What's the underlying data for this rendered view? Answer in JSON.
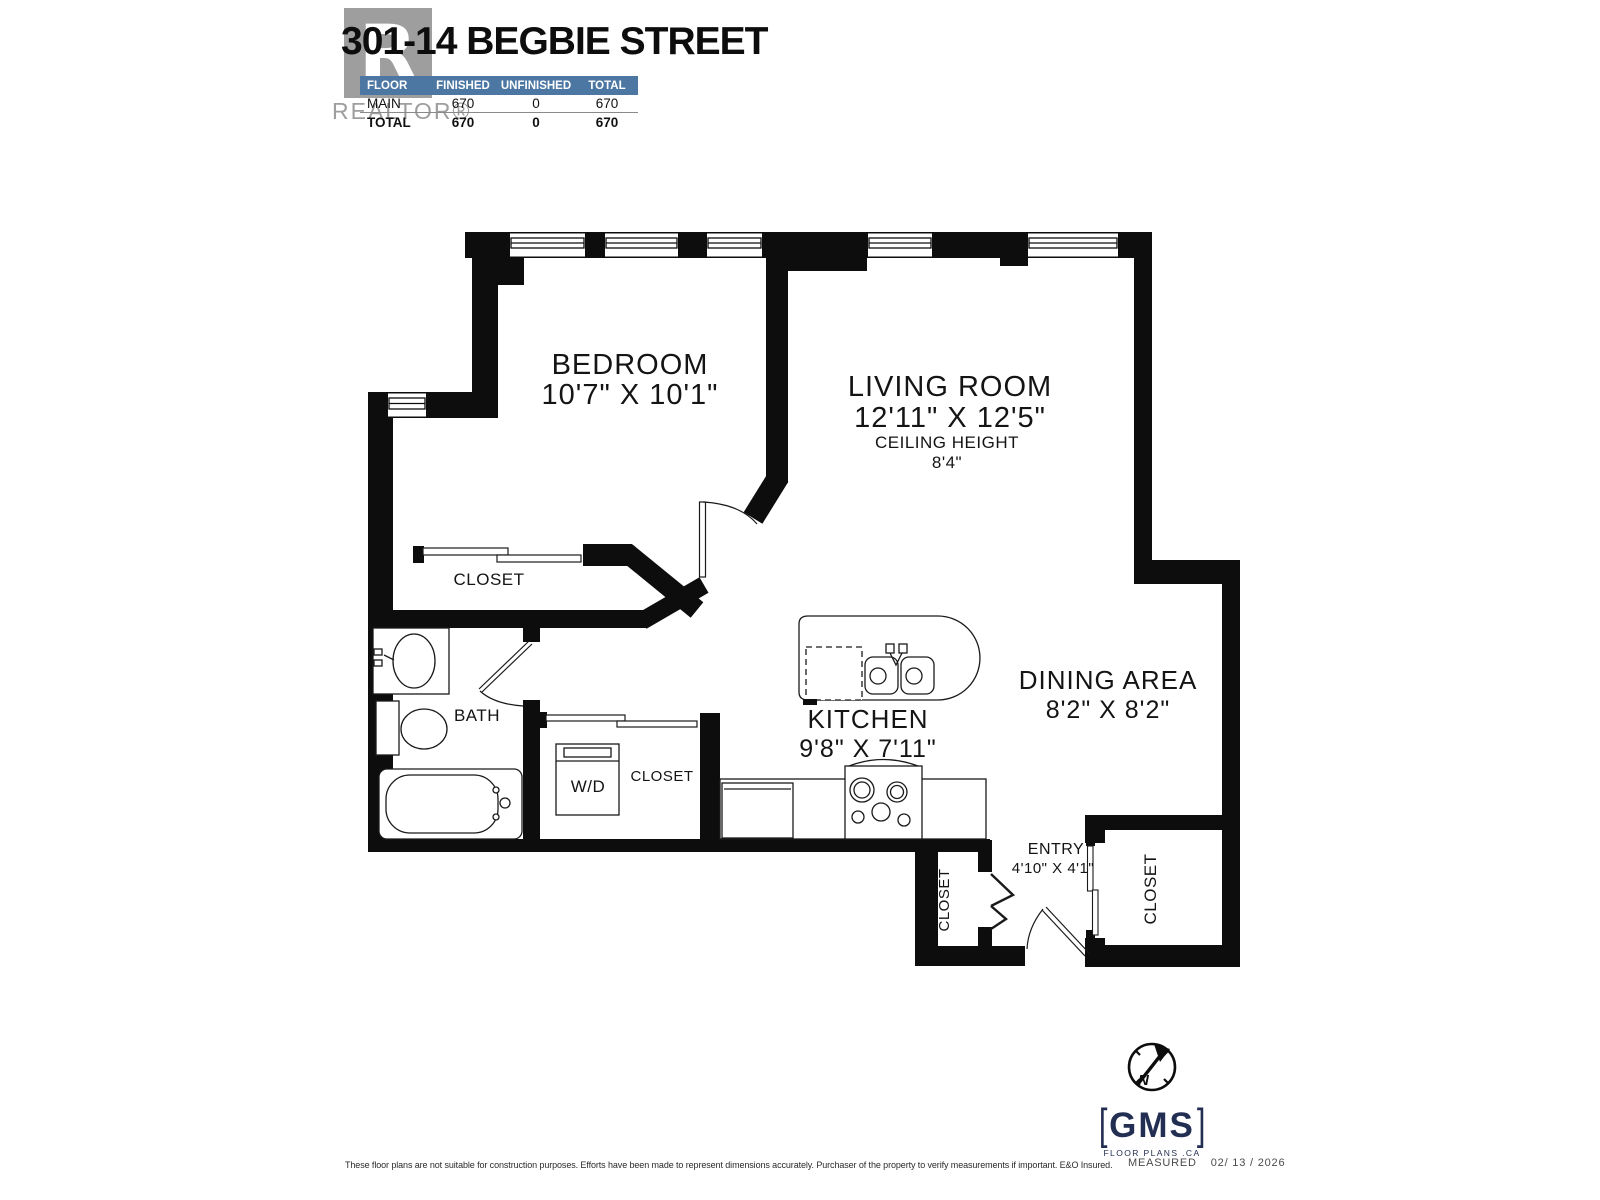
{
  "title": "301-14 BEGBIE STREET",
  "watermark": {
    "letter": "R",
    "brand": "REALTOR®"
  },
  "area_table": {
    "headers": [
      "FLOOR",
      "FINISHED",
      "UNFINISHED",
      "TOTAL"
    ],
    "header_bg": "#4c77a3",
    "rows": [
      {
        "floor": "MAIN",
        "finished": "670",
        "unfinished": "0",
        "total": "670"
      },
      {
        "floor": "TOTAL",
        "finished": "670",
        "unfinished": "0",
        "total": "670"
      }
    ]
  },
  "plan": {
    "bedroom": {
      "name": "BEDROOM",
      "dims": "10'7\" X 10'1\""
    },
    "living_room": {
      "name": "LIVING ROOM",
      "dims": "12'11\" X 12'5\"",
      "ceiling_label": "CEILING HEIGHT",
      "ceiling_value": "8'4\""
    },
    "bedroom_closet": {
      "name": "CLOSET"
    },
    "bath": {
      "name": "BATH"
    },
    "laundry": {
      "name": "W/D"
    },
    "hall_closet": {
      "name": "CLOSET"
    },
    "kitchen": {
      "name": "KITCHEN",
      "dims": "9'8\" X 7'11\""
    },
    "dining": {
      "name": "DINING AREA",
      "dims": "8'2\" X 8'2\""
    },
    "entry": {
      "name": "ENTRY",
      "dims": "4'10\" X 4'1\""
    },
    "entry_closet_left": {
      "name": "CLOSET"
    },
    "entry_closet_right": {
      "name": "CLOSET"
    }
  },
  "footer": {
    "disclaimer": "These floor plans are not suitable for construction purposes. Efforts have been made to represent dimensions accurately.  Purchaser of the property to verify measurements if important.  E&O Insured.",
    "measured_label": "MEASURED",
    "measured_date": "02/ 13 / 2026",
    "logo": {
      "bracket_left": "[",
      "name": "GMS",
      "bracket_right": "]",
      "tagline": "FLOOR PLANS .CA",
      "compass_letter": "N",
      "color": "#232f52"
    }
  }
}
